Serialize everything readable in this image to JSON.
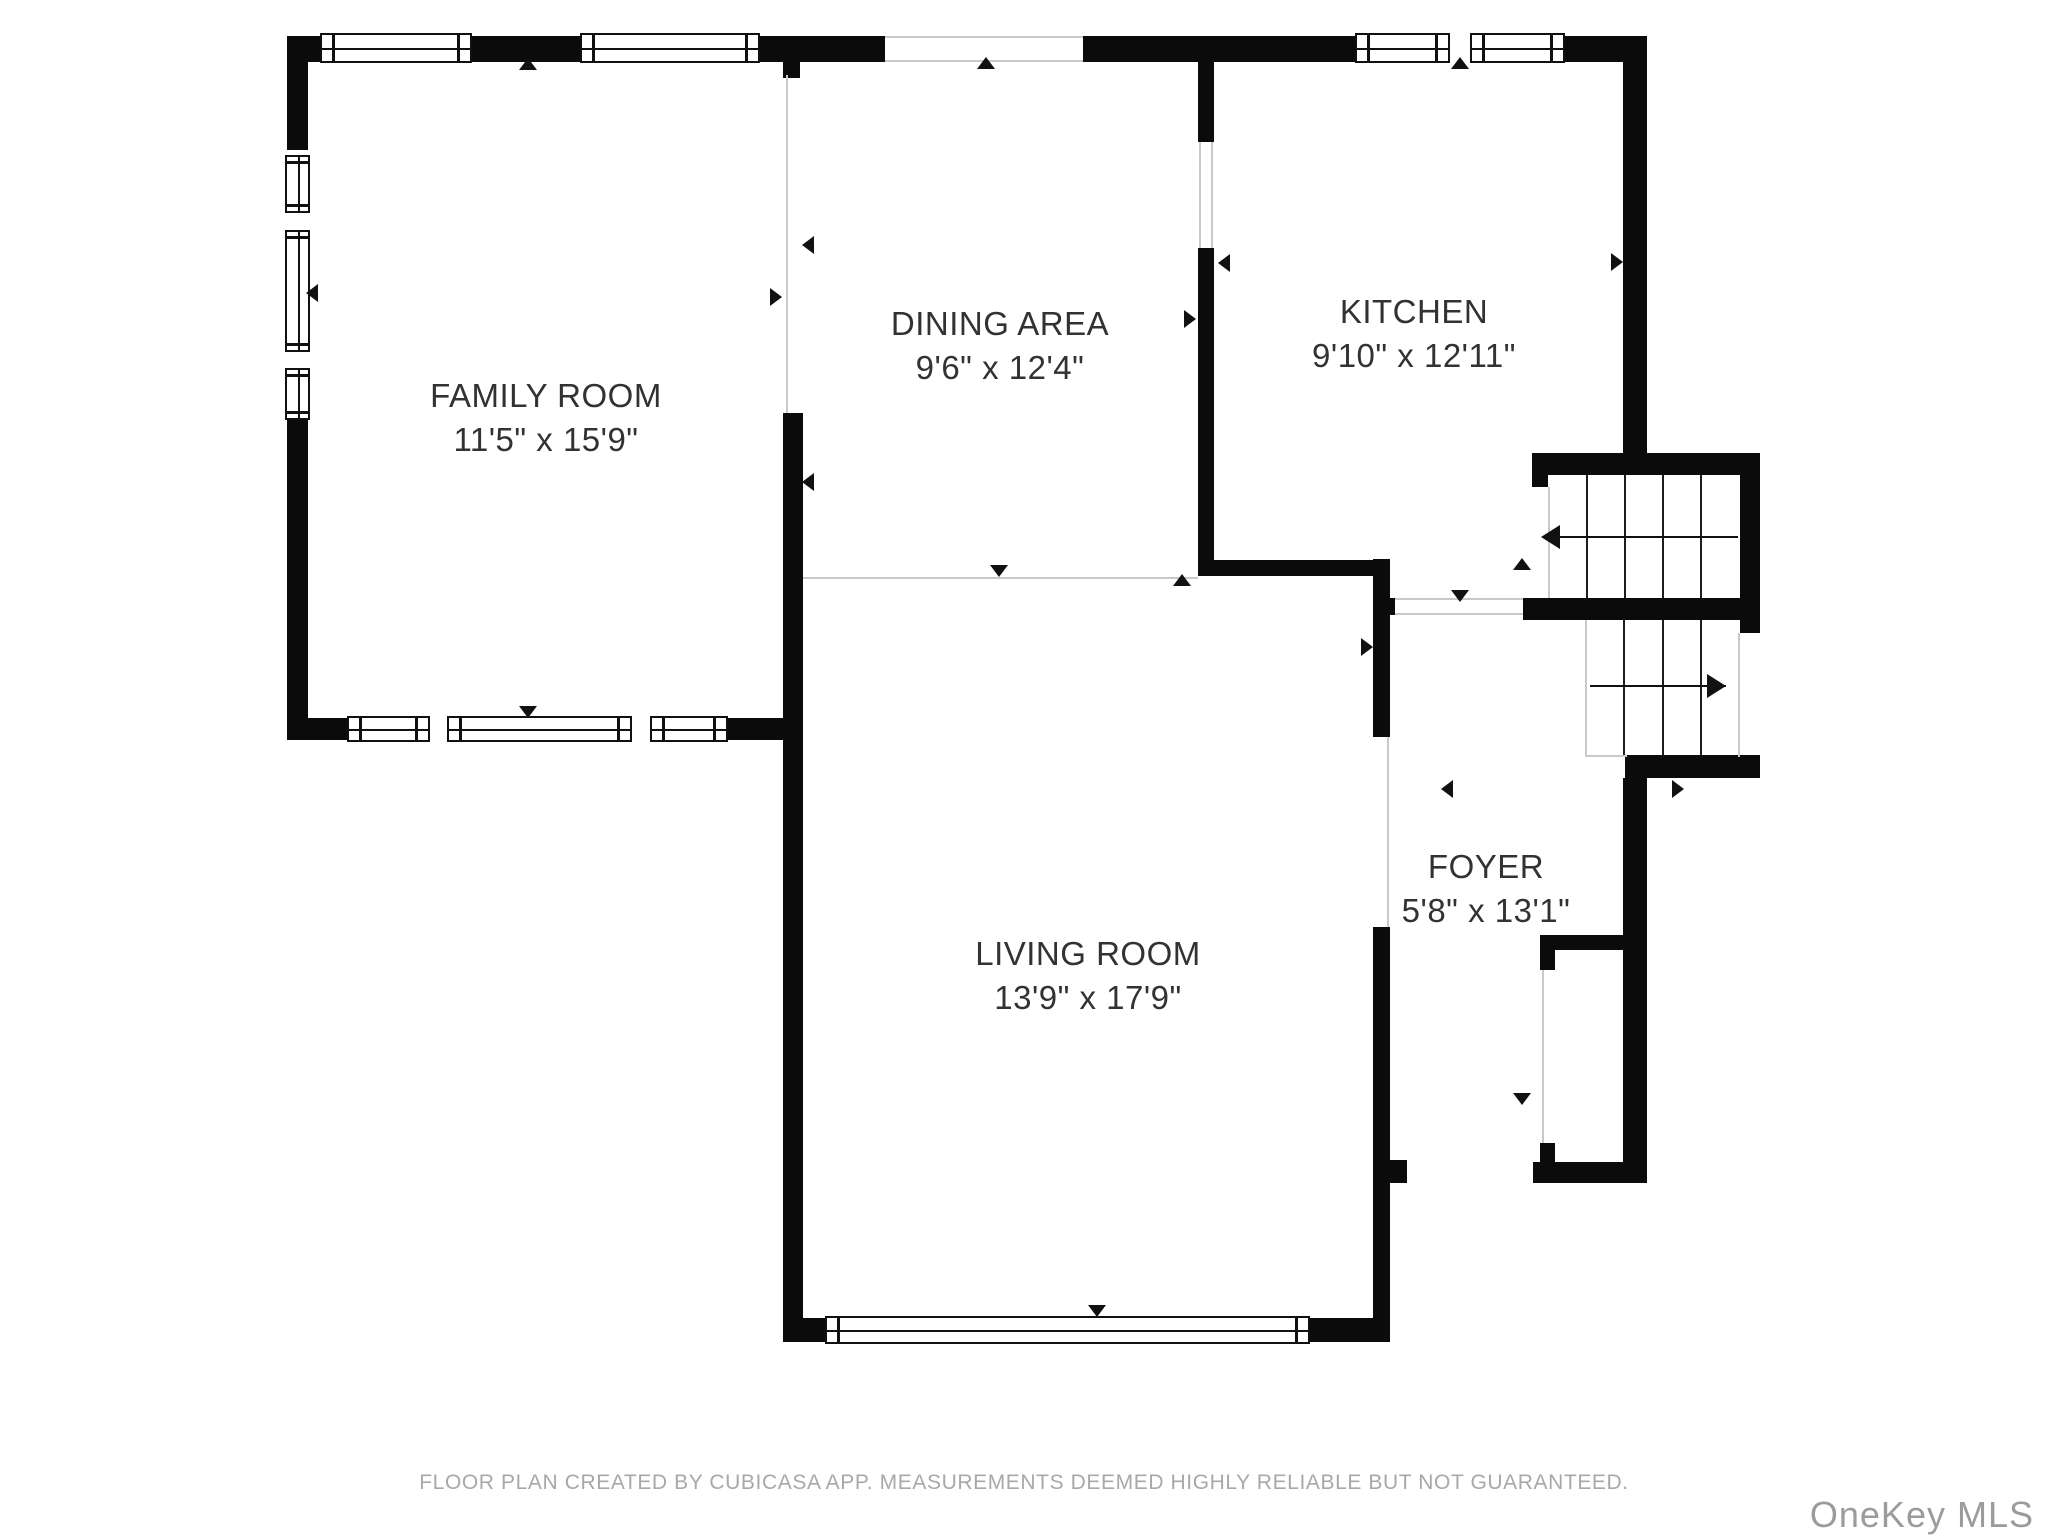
{
  "page_title": "Floor plan - first floor",
  "footer": "FLOOR PLAN CREATED BY CUBICASA APP. MEASUREMENTS DEEMED HIGHLY RELIABLE BUT NOT GUARANTEED.",
  "watermark": "OneKey MLS",
  "colors": {
    "wall": "#0b0b0b",
    "open_boundary_line": "#c9c9c9",
    "label_text": "#323232",
    "footer_text": "#a8a8a8",
    "watermark_text": "#9b9b9b",
    "background": "#ffffff"
  },
  "rooms": [
    {
      "name": "FAMILY ROOM",
      "dims": "11'5\" x 15'9\"",
      "cx": 546,
      "cy": 396
    },
    {
      "name": "DINING AREA",
      "dims": "9'6\" x 12'4\"",
      "cx": 1000,
      "cy": 324
    },
    {
      "name": "KITCHEN",
      "dims": "9'10\" x 12'11\"",
      "cx": 1414,
      "cy": 312
    },
    {
      "name": "LIVING ROOM",
      "dims": "13'9\" x 17'9\"",
      "cx": 1088,
      "cy": 954
    },
    {
      "name": "FOYER",
      "dims": "5'8\" x 13'1\"",
      "cx": 1486,
      "cy": 867
    }
  ],
  "geometry": {
    "walls": [
      [
        287,
        36,
        33,
        26
      ],
      [
        472,
        36,
        108,
        26
      ],
      [
        760,
        36,
        125,
        26
      ],
      [
        1083,
        36,
        272,
        26
      ],
      [
        1565,
        36,
        82,
        26
      ],
      [
        287,
        36,
        21,
        114
      ],
      [
        287,
        420,
        21,
        320
      ],
      [
        287,
        718,
        60,
        22
      ],
      [
        728,
        718,
        75,
        22
      ],
      [
        783,
        52,
        17,
        26
      ],
      [
        783,
        413,
        20,
        929
      ],
      [
        783,
        1318,
        42,
        24
      ],
      [
        1310,
        1318,
        80,
        24
      ],
      [
        1373,
        559,
        17,
        178
      ],
      [
        1373,
        927,
        17,
        415
      ],
      [
        1390,
        1160,
        17,
        23
      ],
      [
        1198,
        58,
        16,
        84
      ],
      [
        1198,
        248,
        16,
        312
      ],
      [
        1198,
        560,
        189,
        16
      ],
      [
        1387,
        598,
        8,
        17
      ],
      [
        1623,
        36,
        24,
        417
      ],
      [
        1532,
        453,
        228,
        22
      ],
      [
        1532,
        475,
        16,
        12
      ],
      [
        1740,
        453,
        20,
        180
      ],
      [
        1523,
        598,
        217,
        22
      ],
      [
        1625,
        755,
        135,
        23
      ],
      [
        1623,
        778,
        24,
        405
      ],
      [
        1540,
        935,
        107,
        15
      ],
      [
        1540,
        950,
        15,
        20
      ],
      [
        1540,
        1143,
        15,
        19
      ],
      [
        1533,
        1162,
        114,
        21
      ]
    ],
    "windows": [
      {
        "x": 320,
        "y": 33,
        "w": 152,
        "h": 30,
        "o": "h"
      },
      {
        "x": 580,
        "y": 33,
        "w": 180,
        "h": 30,
        "o": "h"
      },
      {
        "x": 1355,
        "y": 33,
        "w": 95,
        "h": 30,
        "o": "h"
      },
      {
        "x": 1470,
        "y": 33,
        "w": 95,
        "h": 30,
        "o": "h"
      },
      {
        "x": 285,
        "y": 155,
        "w": 25,
        "h": 58,
        "o": "v"
      },
      {
        "x": 285,
        "y": 230,
        "w": 25,
        "h": 122,
        "o": "v"
      },
      {
        "x": 285,
        "y": 368,
        "w": 25,
        "h": 52,
        "o": "v"
      },
      {
        "x": 347,
        "y": 716,
        "w": 83,
        "h": 26,
        "o": "h"
      },
      {
        "x": 447,
        "y": 716,
        "w": 185,
        "h": 26,
        "o": "h"
      },
      {
        "x": 650,
        "y": 716,
        "w": 78,
        "h": 26,
        "o": "h"
      },
      {
        "x": 825,
        "y": 1316,
        "w": 485,
        "h": 28,
        "o": "h"
      }
    ],
    "thin_lines": [
      [
        786,
        75,
        2,
        338
      ],
      [
        803,
        577,
        395,
        2
      ],
      [
        885,
        36,
        198,
        2
      ],
      [
        885,
        60,
        198,
        2
      ],
      [
        1199,
        142,
        2,
        106
      ],
      [
        1211,
        142,
        2,
        106
      ],
      [
        1395,
        598,
        128,
        2
      ],
      [
        1395,
        613,
        128,
        2
      ],
      [
        1387,
        737,
        2,
        190
      ],
      [
        1542,
        970,
        2,
        173
      ],
      [
        1548,
        487,
        2,
        111
      ],
      [
        1585,
        620,
        2,
        137
      ],
      [
        1738,
        633,
        2,
        124
      ],
      [
        1585,
        755,
        42,
        2
      ]
    ],
    "stair_treads": [
      [
        1586,
        475,
        2,
        123
      ],
      [
        1624,
        475,
        2,
        123
      ],
      [
        1662,
        475,
        2,
        123
      ],
      [
        1700,
        475,
        2,
        123
      ],
      [
        1623,
        620,
        2,
        135
      ],
      [
        1662,
        620,
        2,
        135
      ],
      [
        1700,
        620,
        2,
        135
      ]
    ],
    "stair_arrows": [
      {
        "line": [
          1560,
          536,
          178,
          2
        ],
        "head": "left",
        "hx": 1541,
        "hy": 537
      },
      {
        "line": [
          1590,
          685,
          136,
          2
        ],
        "head": "right",
        "hx": 1726,
        "hy": 686
      }
    ],
    "direction_markers": [
      {
        "dir": "up",
        "x": 528,
        "y": 64
      },
      {
        "dir": "up",
        "x": 986,
        "y": 63
      },
      {
        "dir": "up",
        "x": 1460,
        "y": 63
      },
      {
        "dir": "up",
        "x": 1182,
        "y": 580
      },
      {
        "dir": "up",
        "x": 1522,
        "y": 564
      },
      {
        "dir": "down",
        "x": 999,
        "y": 571
      },
      {
        "dir": "down",
        "x": 1460,
        "y": 596
      },
      {
        "dir": "down",
        "x": 528,
        "y": 712
      },
      {
        "dir": "down",
        "x": 1097,
        "y": 1311
      },
      {
        "dir": "down",
        "x": 1522,
        "y": 1099
      },
      {
        "dir": "left",
        "x": 312,
        "y": 293
      },
      {
        "dir": "left",
        "x": 808,
        "y": 245
      },
      {
        "dir": "left",
        "x": 1224,
        "y": 263
      },
      {
        "dir": "left",
        "x": 808,
        "y": 482
      },
      {
        "dir": "left",
        "x": 1447,
        "y": 789
      },
      {
        "dir": "right",
        "x": 776,
        "y": 297
      },
      {
        "dir": "right",
        "x": 1190,
        "y": 319
      },
      {
        "dir": "right",
        "x": 1617,
        "y": 262
      },
      {
        "dir": "right",
        "x": 1367,
        "y": 647
      },
      {
        "dir": "right",
        "x": 1678,
        "y": 789
      }
    ]
  }
}
